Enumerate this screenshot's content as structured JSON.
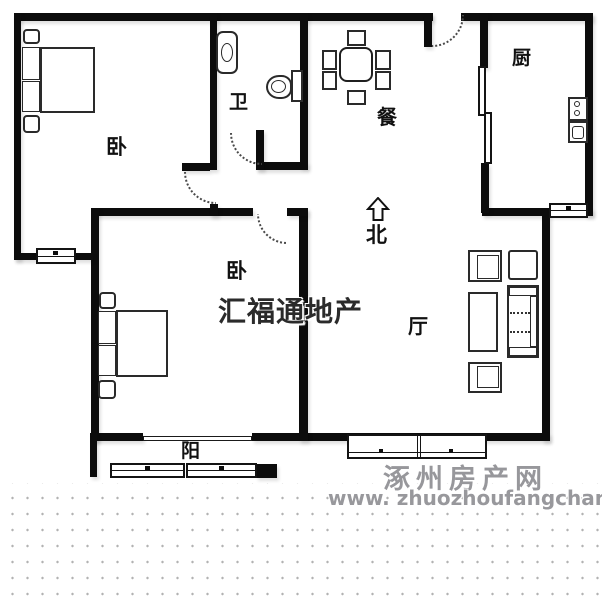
{
  "meta": {
    "type": "real-estate floor plan image",
    "width_px": 602,
    "height_px": 600
  },
  "rooms": [
    {
      "id": "bedroom-1",
      "label": "卧"
    },
    {
      "id": "bathroom",
      "label": "卫"
    },
    {
      "id": "dining",
      "label": "餐"
    },
    {
      "id": "kitchen",
      "label": "厨"
    },
    {
      "id": "bedroom-2",
      "label": "卧"
    },
    {
      "id": "living",
      "label": "厅"
    },
    {
      "id": "balcony",
      "label": "阳"
    }
  ],
  "compass": {
    "label": "北"
  },
  "watermarks": {
    "agency": "汇福通地产",
    "site_name": "涿州房产网",
    "site_url": "www. zhuozhoufangchan. com"
  },
  "colors": {
    "wall": "#0c0c0c",
    "furniture_line": "#1f1f1f",
    "watermark_gray": "#97979b",
    "dot_gray": "#b2b2b2",
    "background": "#ffffff"
  }
}
